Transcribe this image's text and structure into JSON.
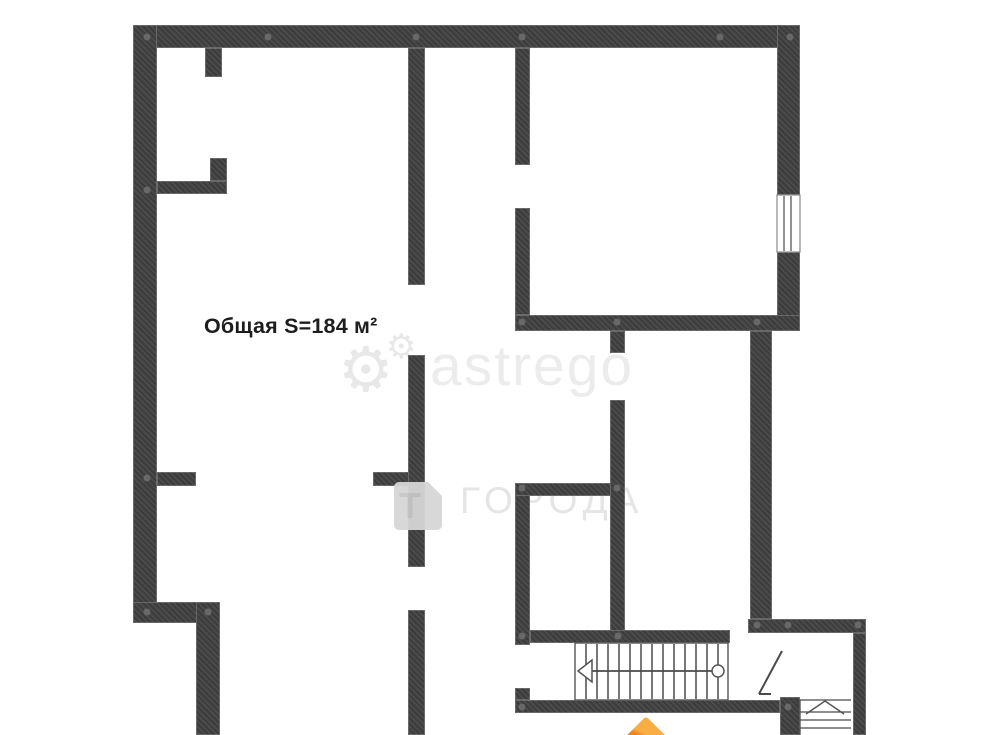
{
  "page": {
    "width": 1000,
    "height": 735,
    "background": "#ffffff"
  },
  "floorplan": {
    "area_label": "Общая S=184 м²",
    "wall_color": "#3c3c3c",
    "hatch_color": "#4a4a4a",
    "dot_color": "#6e6e6e",
    "walls": [
      {
        "x": 133,
        "y": 25,
        "w": 667,
        "h": 23
      },
      {
        "x": 133,
        "y": 25,
        "w": 24,
        "h": 598
      },
      {
        "x": 777,
        "y": 25,
        "w": 23,
        "h": 170
      },
      {
        "x": 777,
        "y": 252,
        "w": 23,
        "h": 79
      },
      {
        "x": 515,
        "y": 315,
        "w": 285,
        "h": 16
      },
      {
        "x": 750,
        "y": 331,
        "w": 22,
        "h": 288
      },
      {
        "x": 748,
        "y": 619,
        "w": 118,
        "h": 14
      },
      {
        "x": 853,
        "y": 633,
        "w": 13,
        "h": 102
      },
      {
        "x": 133,
        "y": 602,
        "w": 87,
        "h": 21
      },
      {
        "x": 196,
        "y": 602,
        "w": 24,
        "h": 133
      },
      {
        "x": 515,
        "y": 700,
        "w": 265,
        "h": 13
      },
      {
        "x": 780,
        "y": 697,
        "w": 20,
        "h": 38
      },
      {
        "x": 205,
        "y": 48,
        "w": 17,
        "h": 29
      },
      {
        "x": 157,
        "y": 181,
        "w": 70,
        "h": 13
      },
      {
        "x": 210,
        "y": 158,
        "w": 17,
        "h": 23
      },
      {
        "x": 157,
        "y": 472,
        "w": 39,
        "h": 14
      },
      {
        "x": 373,
        "y": 472,
        "w": 37,
        "h": 14
      },
      {
        "x": 408,
        "y": 48,
        "w": 17,
        "h": 237
      },
      {
        "x": 408,
        "y": 355,
        "w": 17,
        "h": 212
      },
      {
        "x": 408,
        "y": 610,
        "w": 17,
        "h": 125
      },
      {
        "x": 515,
        "y": 48,
        "w": 15,
        "h": 117
      },
      {
        "x": 515,
        "y": 208,
        "w": 15,
        "h": 107
      },
      {
        "x": 515,
        "y": 483,
        "w": 15,
        "h": 162
      },
      {
        "x": 515,
        "y": 688,
        "w": 15,
        "h": 12
      },
      {
        "x": 515,
        "y": 483,
        "w": 110,
        "h": 13
      },
      {
        "x": 610,
        "y": 331,
        "w": 15,
        "h": 22
      },
      {
        "x": 610,
        "y": 400,
        "w": 15,
        "h": 243
      },
      {
        "x": 530,
        "y": 630,
        "w": 200,
        "h": 13
      }
    ],
    "dots": [
      {
        "x": 147,
        "y": 37
      },
      {
        "x": 268,
        "y": 37
      },
      {
        "x": 416,
        "y": 37
      },
      {
        "x": 522,
        "y": 37
      },
      {
        "x": 720,
        "y": 37
      },
      {
        "x": 790,
        "y": 37
      },
      {
        "x": 147,
        "y": 190
      },
      {
        "x": 147,
        "y": 478
      },
      {
        "x": 147,
        "y": 612
      },
      {
        "x": 208,
        "y": 612
      },
      {
        "x": 522,
        "y": 322
      },
      {
        "x": 617,
        "y": 322
      },
      {
        "x": 757,
        "y": 322
      },
      {
        "x": 522,
        "y": 488
      },
      {
        "x": 617,
        "y": 488
      },
      {
        "x": 522,
        "y": 636
      },
      {
        "x": 618,
        "y": 636
      },
      {
        "x": 757,
        "y": 625
      },
      {
        "x": 788,
        "y": 625
      },
      {
        "x": 858,
        "y": 625
      },
      {
        "x": 522,
        "y": 707
      },
      {
        "x": 788,
        "y": 707
      }
    ],
    "svg": {
      "rects": [
        {
          "name": "window",
          "x": 777,
          "y": 195,
          "w": 23,
          "h": 57,
          "fill": "#ffffff",
          "stroke": "#8a8a8a",
          "sw": 1.2
        },
        {
          "name": "main-staircase",
          "x": 575,
          "y": 643,
          "w": 153,
          "h": 57,
          "fill": "#ffffff",
          "stroke": "#555555",
          "sw": 1.4
        }
      ],
      "lines": [
        {
          "name": "window-mullion",
          "x1": 784,
          "y1": 196,
          "x2": 784,
          "y2": 251,
          "sw": 1.2
        },
        {
          "name": "window-mullion",
          "x1": 791,
          "y1": 196,
          "x2": 791,
          "y2": 251,
          "sw": 1.2
        },
        {
          "name": "stair-riser",
          "x1": 586,
          "y1": 644,
          "x2": 586,
          "y2": 699,
          "sw": 1.5
        },
        {
          "name": "stair-riser",
          "x1": 597,
          "y1": 644,
          "x2": 597,
          "y2": 699,
          "sw": 1.5
        },
        {
          "name": "stair-riser",
          "x1": 608,
          "y1": 644,
          "x2": 608,
          "y2": 699,
          "sw": 1.5
        },
        {
          "name": "stair-riser",
          "x1": 619,
          "y1": 644,
          "x2": 619,
          "y2": 699,
          "sw": 1.5
        },
        {
          "name": "stair-riser",
          "x1": 630,
          "y1": 644,
          "x2": 630,
          "y2": 699,
          "sw": 1.5
        },
        {
          "name": "stair-riser",
          "x1": 641,
          "y1": 644,
          "x2": 641,
          "y2": 699,
          "sw": 1.5
        },
        {
          "name": "stair-riser",
          "x1": 652,
          "y1": 644,
          "x2": 652,
          "y2": 699,
          "sw": 1.5
        },
        {
          "name": "stair-riser",
          "x1": 663,
          "y1": 644,
          "x2": 663,
          "y2": 699,
          "sw": 1.5
        },
        {
          "name": "stair-riser",
          "x1": 674,
          "y1": 644,
          "x2": 674,
          "y2": 699,
          "sw": 1.5
        },
        {
          "name": "stair-riser",
          "x1": 685,
          "y1": 644,
          "x2": 685,
          "y2": 699,
          "sw": 1.5
        },
        {
          "name": "stair-riser",
          "x1": 696,
          "y1": 644,
          "x2": 696,
          "y2": 699,
          "sw": 1.5
        },
        {
          "name": "stair-riser",
          "x1": 707,
          "y1": 644,
          "x2": 707,
          "y2": 699,
          "sw": 1.5
        },
        {
          "name": "stair-riser",
          "x1": 718,
          "y1": 644,
          "x2": 718,
          "y2": 699,
          "sw": 1.5
        },
        {
          "name": "stair-center-line",
          "x1": 578,
          "y1": 671,
          "x2": 712,
          "y2": 671,
          "sw": 1.8
        },
        {
          "name": "door-swing",
          "x1": 782,
          "y1": 651,
          "x2": 759,
          "y2": 694,
          "sw": 2
        },
        {
          "name": "door-swing-tick",
          "x1": 759,
          "y1": 694,
          "x2": 771,
          "y2": 694,
          "sw": 2
        },
        {
          "name": "entry-stair-edge",
          "x1": 800,
          "y1": 700,
          "x2": 851,
          "y2": 700,
          "sw": 1.3
        },
        {
          "name": "entry-stair-step",
          "x1": 800,
          "y1": 712,
          "x2": 851,
          "y2": 712,
          "sw": 1.3
        },
        {
          "name": "entry-stair-step",
          "x1": 800,
          "y1": 720,
          "x2": 851,
          "y2": 720,
          "sw": 1.3
        },
        {
          "name": "entry-stair-step",
          "x1": 800,
          "y1": 728,
          "x2": 851,
          "y2": 728,
          "sw": 1.3
        },
        {
          "name": "entry-stair-side",
          "x1": 800,
          "y1": 700,
          "x2": 800,
          "y2": 735,
          "sw": 1.3
        }
      ],
      "polygons": [
        {
          "name": "stair-direction-arrow",
          "points": "592,660 578,671 592,682",
          "fill": "#ffffff",
          "stroke": "#555555",
          "sw": 1.5
        }
      ],
      "polylines": [
        {
          "name": "entry-stair-arrow",
          "points": "806,714 825,701 844,714",
          "stroke": "#555555",
          "sw": 1.5
        }
      ],
      "circles": [
        {
          "name": "stair-start-circle",
          "cx": 718,
          "cy": 671,
          "r": 6,
          "fill": "#ffffff",
          "stroke": "#555555",
          "sw": 1.5
        }
      ],
      "stroke_default": "#4a4a4a"
    }
  },
  "watermarks": {
    "astrego_text": "astrego",
    "goroda_text": "ГОРОДА",
    "gear_glyph": "⚙",
    "logo_letter": "Т",
    "light_gray": "#ececec"
  },
  "branding": {
    "accent_orange": "#ed871d"
  }
}
